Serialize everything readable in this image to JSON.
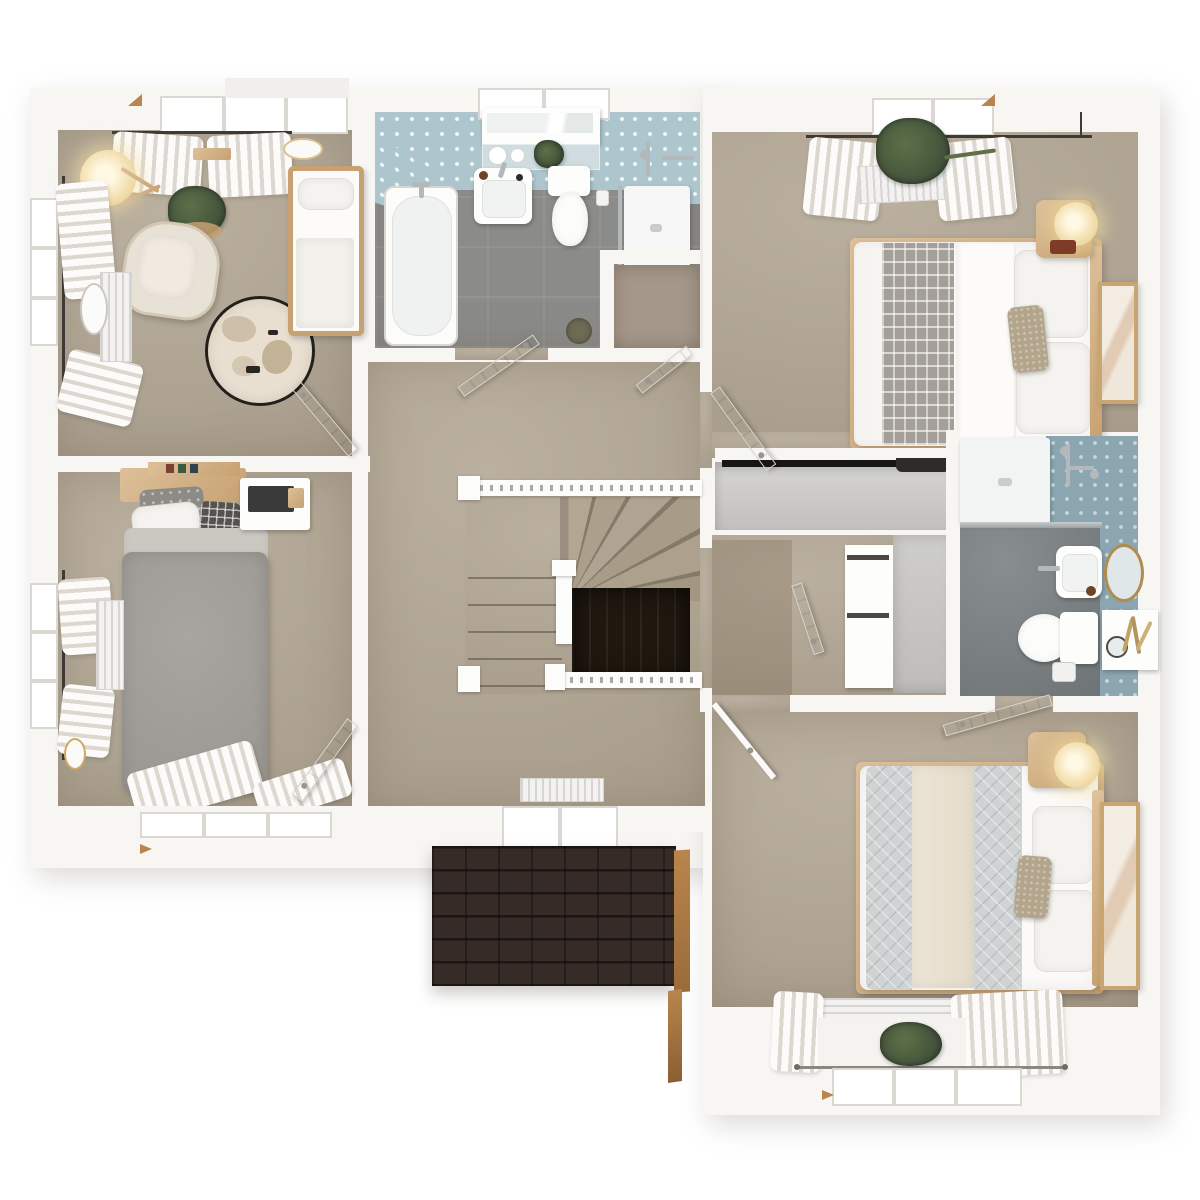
{
  "scene": {
    "type": "3d-rendered-floor-plan",
    "view": "top-down-dollhouse",
    "text_visible": "none"
  },
  "palette": {
    "wall": "#f7f6f3",
    "white": "#fdfdfc",
    "carpet": "#b3a794",
    "carpetDark": "#a3947f",
    "bathFloor": "#8b8b89",
    "ensFloor": "#7e8486",
    "tileBlue": "#adc6ce",
    "tileSlate": "#8ba6b0",
    "wood": "#c7a171",
    "woodLight": "#ddc09a",
    "woodDeep": "#b9854c",
    "roof": "#362b26",
    "voidWood": "#20180f",
    "fabricGray": "#9b9893",
    "fabricCream": "#e9e1d1",
    "glow": "#f3dfae",
    "chrome": "#b3b8ba",
    "gold": "#b08d4f",
    "green": "#42513a",
    "greenLight": "#5d7048",
    "railDark": "#3e3a35",
    "taupe": "#b3a58b",
    "wardrobeGray": "#d6d5d3",
    "closetShade": "#a5988a"
  },
  "rooms": [
    {
      "id": "nursery",
      "position": "top-left",
      "furniture": [
        "cot",
        "armchair",
        "floor-lamp",
        "plant",
        "round-map-rug",
        "radiator",
        "standing-mirror",
        "wall-shelf",
        "ceiling-light",
        "window-top",
        "window-left",
        "curtains",
        "door"
      ]
    },
    {
      "id": "bedroom-4",
      "position": "middle-left",
      "furniture": [
        "single-bed",
        "headboard-shelf",
        "desk",
        "laptop",
        "radiator",
        "wall-clock",
        "window-left",
        "window-bottom",
        "curtains",
        "door"
      ]
    },
    {
      "id": "family-bathroom",
      "position": "top-middle",
      "furniture": [
        "bathtub",
        "washbasin",
        "mirror-cabinet",
        "shelf-toiletries",
        "toilet",
        "walk-in-shower",
        "airing-cupboard",
        "bin",
        "door"
      ]
    },
    {
      "id": "master-bedroom",
      "position": "top-right",
      "furniture": [
        "double-bed",
        "gray-runner",
        "pillows",
        "nightstand",
        "table-lamp",
        "fitted-wardrobe",
        "radiator",
        "hanging-plant",
        "leaning-artwork",
        "curtains",
        "door"
      ]
    },
    {
      "id": "ensuite-bathroom",
      "position": "middle-right",
      "furniture": [
        "shower-tray",
        "glass-screen",
        "washbasin",
        "oval-gold-mirror",
        "toilet",
        "shelf-unit",
        "dried-plant",
        "door"
      ]
    },
    {
      "id": "bedroom-2",
      "position": "bottom-right",
      "furniture": [
        "double-bed",
        "quilt",
        "pillows",
        "nightstand",
        "table-lamp",
        "leaning-artwork",
        "radiator",
        "windowsill-plant",
        "curtains",
        "door"
      ]
    },
    {
      "id": "landing",
      "position": "center",
      "furniture": [
        "winder-staircase",
        "balustrade",
        "stairwell-void",
        "radiator",
        "window-bottom",
        "airing-cupboard-door"
      ]
    },
    {
      "id": "inner-hallway",
      "position": "center-right",
      "furniture": [
        "open-shelf-unit",
        "wardrobe-recess",
        "door"
      ]
    },
    {
      "id": "exterior",
      "position": "bottom-middle",
      "furniture": [
        "porch-roof-shingles",
        "roof-fascia"
      ]
    }
  ]
}
